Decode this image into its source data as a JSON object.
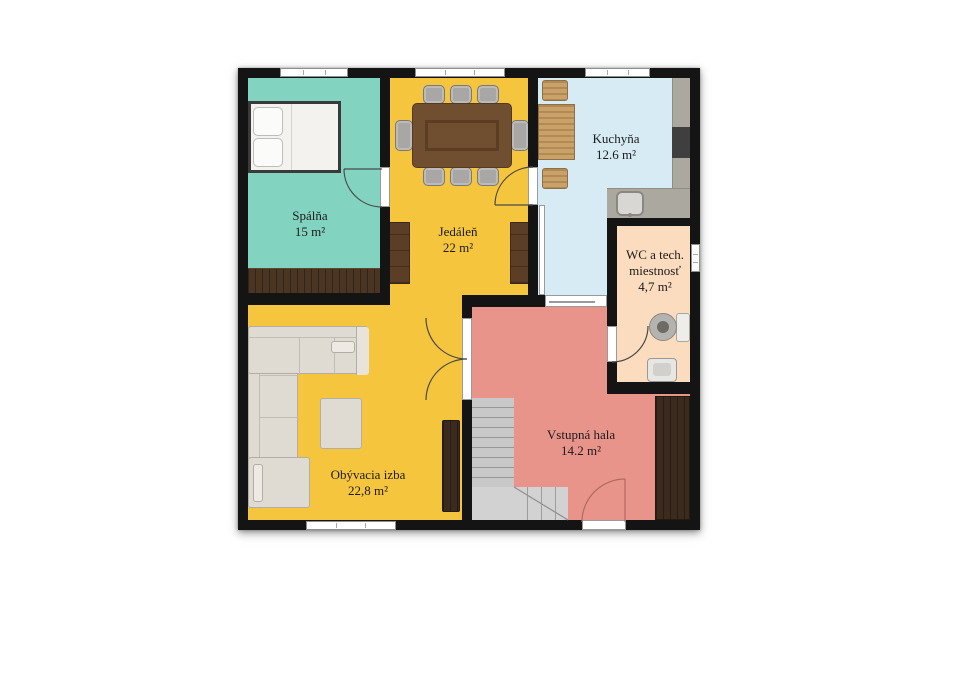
{
  "rooms": {
    "bedroom": {
      "name": "Spálňa",
      "area": "15 m²",
      "color": "#82d3c0"
    },
    "dining": {
      "name": "Jedáleň",
      "area": "22 m²",
      "color": "#f6c53e"
    },
    "living": {
      "name": "Obývacia izba",
      "area": "22,8 m²",
      "color": "#f6c53e"
    },
    "kitchen": {
      "name": "Kuchyňa",
      "area": "12.6 m²",
      "color": "#d6ebf3"
    },
    "wc": {
      "name_line1": "WC a tech.",
      "name_line2": "miestnosť",
      "area": "4,7 m²",
      "color": "#fbdcbe"
    },
    "hall": {
      "name": "Vstupná hala",
      "area": "14.2 m²",
      "color": "#e9948b"
    }
  },
  "colors": {
    "wall": "#141414",
    "window": "#ffffff",
    "counter": "#aba8a0",
    "stove": "#3f3f3f",
    "stairs": "#c8c8c8",
    "stairs_turn": "#d2d2d2",
    "dark_wood": "#3a2b1e",
    "bedroom_wardrobe": "#4a3523",
    "dining_table": "#6f4f2f",
    "sofa": "#dfdad2",
    "bed_mattress": "#f3f2ef"
  }
}
